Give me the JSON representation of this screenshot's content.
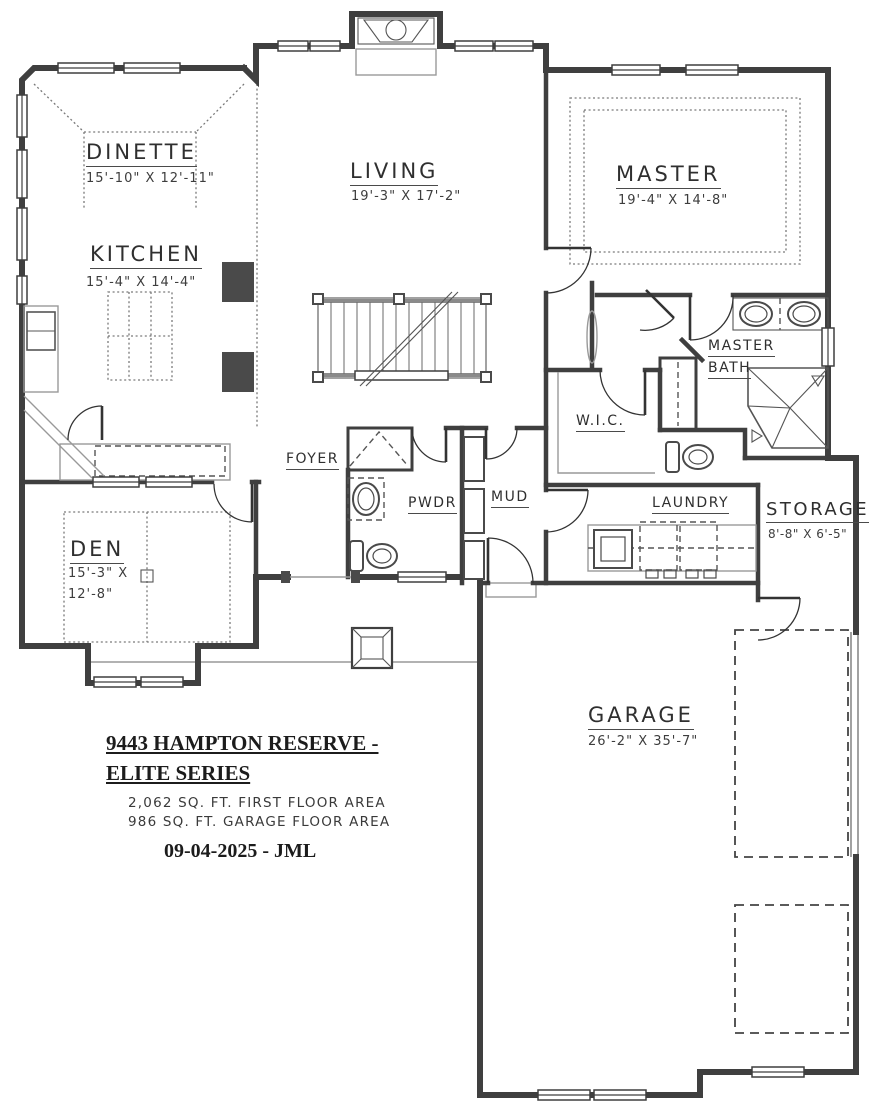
{
  "plan": {
    "rooms": {
      "dinette": {
        "name": "DINETTE",
        "dims": "15'-10\" X 12'-11\""
      },
      "kitchen": {
        "name": "KITCHEN",
        "dims": "15'-4\" X 14'-4\""
      },
      "living": {
        "name": "LIVING",
        "dims": "19'-3\" X 17'-2\""
      },
      "master": {
        "name": "MASTER",
        "dims": "19'-4\" X 14'-8\""
      },
      "master_bath": {
        "line1": "MASTER",
        "line2": "BATH"
      },
      "wic": {
        "name": "W.I.C."
      },
      "foyer": {
        "name": "FOYER"
      },
      "pwdr": {
        "name": "PWDR"
      },
      "mud": {
        "name": "MUD"
      },
      "laundry": {
        "name": "LAUNDRY"
      },
      "storage": {
        "name": "STORAGE",
        "dims": "8'-8\" X 6'-5\""
      },
      "den": {
        "name": "DEN",
        "dims_line1": "15'-3\" X",
        "dims_line2": "12'-8\""
      },
      "garage": {
        "name": "GARAGE",
        "dims": "26'-2\" X 35'-7\""
      }
    },
    "title_block": {
      "title_line1": "9443 HAMPTON RESERVE -",
      "title_line2": "ELITE SERIES",
      "floor_area": "2,062 SQ. FT. FIRST FLOOR AREA",
      "garage_area": "986 SQ. FT. GARAGE FLOOR AREA",
      "date_signature": "09-04-2025 - JML"
    },
    "colors": {
      "wall": "#3f3f3f",
      "light_line": "#999999"
    }
  }
}
